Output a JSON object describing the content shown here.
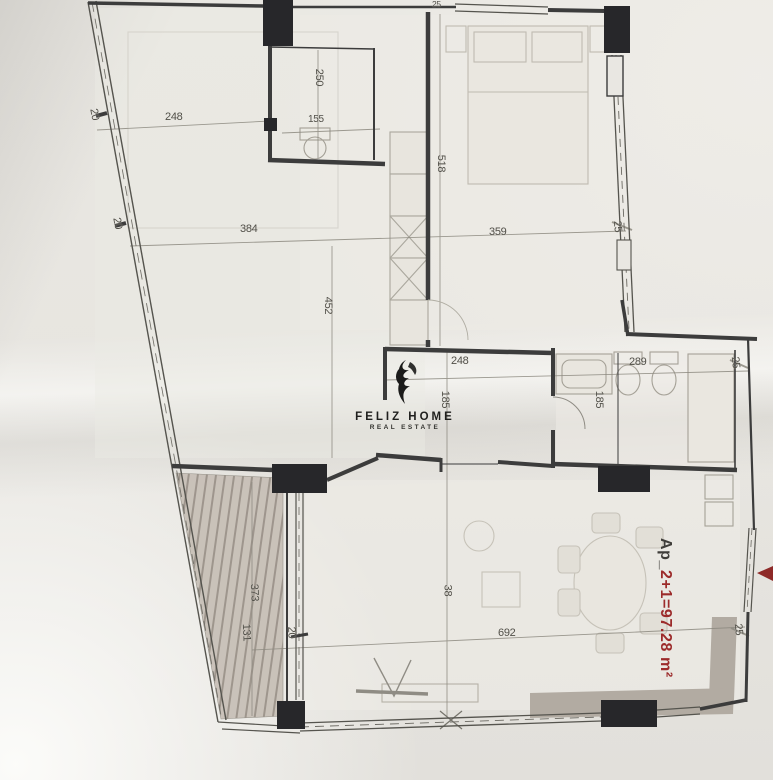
{
  "logo": {
    "brand": "FELIZ HOME",
    "tagline": "REAL ESTATE"
  },
  "area": {
    "prefix": "Ap_",
    "value": "2+1=97.28 m²"
  },
  "dimensions": {
    "top_wall_tick": "25",
    "left_wall_upper_tick": "20",
    "living_top_width": "248",
    "closet_depth": "250",
    "closet_width": "155",
    "bedroom_height": "518",
    "living_width": "384",
    "bedroom_width": "359",
    "bedroom_wall_tick": "25",
    "living_height": "452",
    "left_wall_lower_tick": "20",
    "hall_width": "248",
    "hall_depth": "185",
    "bath_width": "289",
    "bath_depth": "185",
    "right_wall_tick_upper": "25",
    "balcony_length": "373",
    "balcony_width": "131",
    "balcony_door_tick": "20",
    "salon_depth": "38",
    "salon_width": "692",
    "right_wall_tick_lower": "25"
  },
  "colors": {
    "area_text": "#9c2b2b",
    "walls": "#3c3c3c",
    "columns": "#27272a",
    "balcony_hatch": "#968d84",
    "kitchen_counter": "#b2aba2",
    "logo": "#1f1f1d"
  }
}
